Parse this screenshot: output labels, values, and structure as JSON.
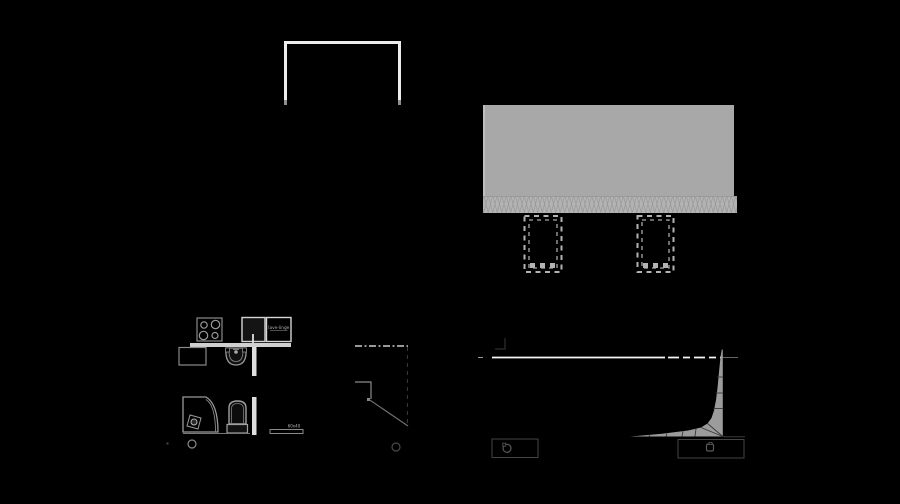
{
  "canvas": {
    "width": 900,
    "height": 504,
    "background": "#000000"
  },
  "labels": {
    "appliance_box": "lave-linge",
    "shelf_dim": "60x40"
  },
  "colors": {
    "bright_line": "#f2f2f2",
    "light_line": "#c9c9c9",
    "mid_line": "#8f8f8f",
    "faint_line": "#3a3a3a",
    "slab_fill": "#a8a8a8",
    "insulation_fill": "#b3b3b3",
    "terrain_wedge_fill": "#9c9c9c",
    "counter_fill": "#d0d0d0",
    "wall_fill": "#dedede"
  },
  "elements": {
    "top_left": "wall-opening-elevation",
    "top_right": [
      "roof-slab-section",
      "insulation-hatch",
      "dashed-column-left",
      "dashed-column-right"
    ],
    "bottom_left": [
      "kitchen-plan",
      "cooktop",
      "kitchen-sink",
      "appliance-box",
      "counter",
      "washbasin",
      "shower-tray",
      "toilet",
      "towel-shelf",
      "marker-circle"
    ],
    "bottom_middle": [
      "stair-step-profile",
      "dashed-reference-lines",
      "marker-circle"
    ],
    "bottom_right": [
      "ground-line",
      "terrain-wedge-section",
      "title-stamp-left",
      "title-stamp-right"
    ]
  }
}
